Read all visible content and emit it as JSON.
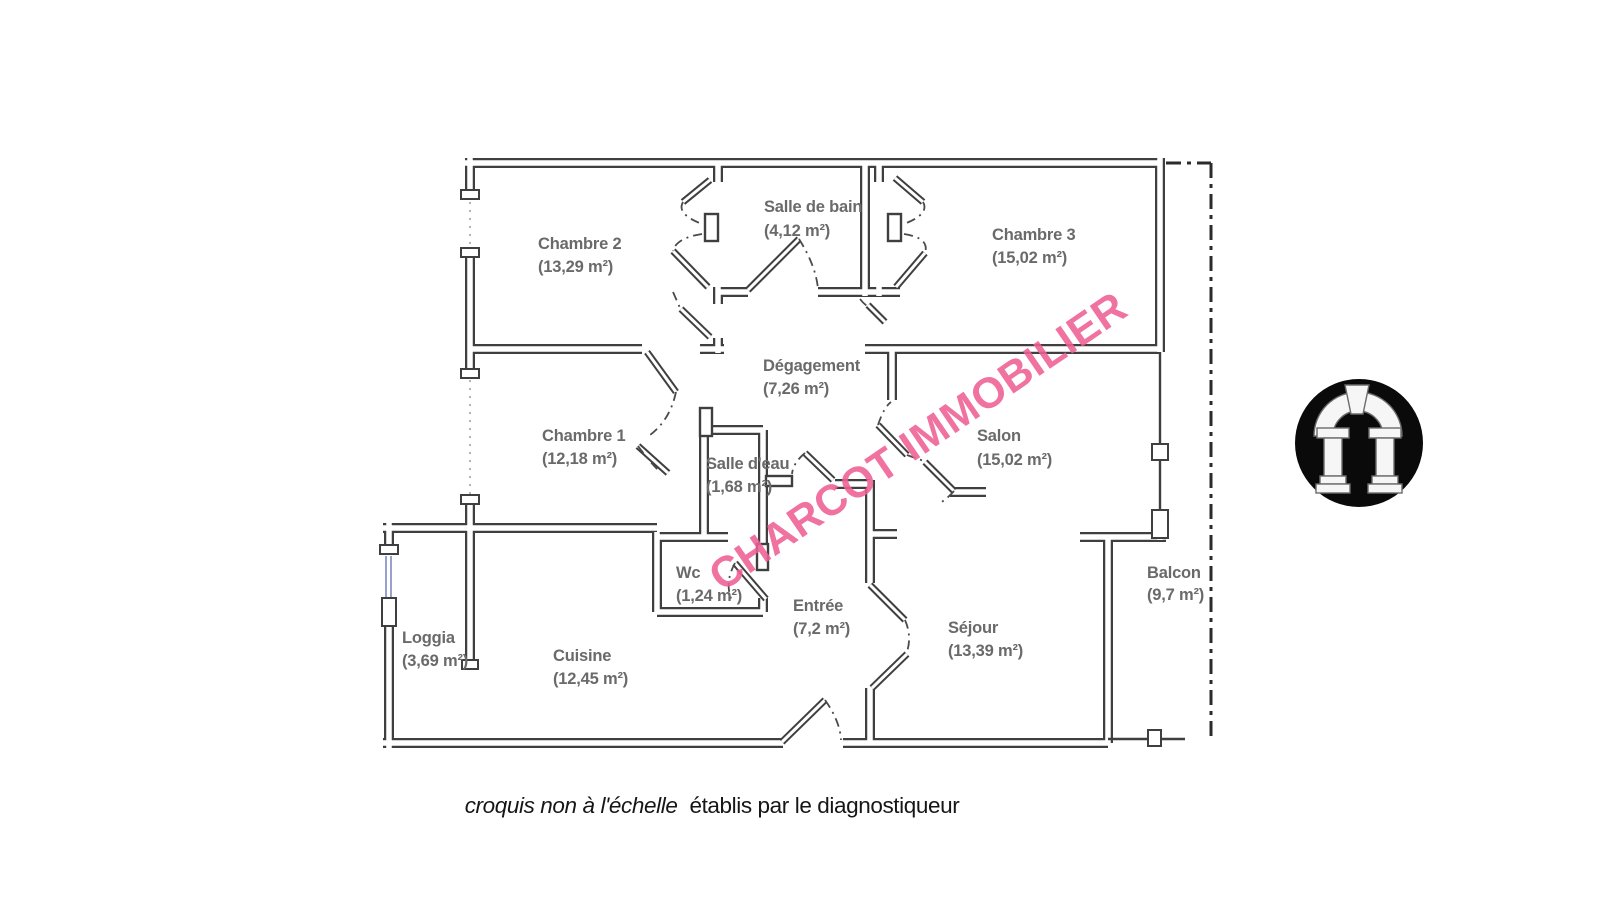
{
  "watermark": {
    "text": "CHARCOT IMMOBILIER",
    "color": "#ef5f94"
  },
  "caption": {
    "italic_part": "croquis non à l'échelle",
    "regular_part": "établis par le diagnostiqueur"
  },
  "rooms": [
    {
      "name": "Chambre 2",
      "area": "(13,29 m²)"
    },
    {
      "name": "Salle de bain",
      "area": "(4,12 m²)"
    },
    {
      "name": "Chambre 3",
      "area": "(15,02 m²)"
    },
    {
      "name": "Dégagement",
      "area": "(7,26 m²)"
    },
    {
      "name": "Chambre 1",
      "area": "(12,18 m²)"
    },
    {
      "name": "Salle d'eau",
      "area": "(1,68 m²)"
    },
    {
      "name": "Salon",
      "area": "(15,02 m²)"
    },
    {
      "name": "Wc",
      "area": "(1,24 m²)"
    },
    {
      "name": "Entrée",
      "area": "(7,2 m²)"
    },
    {
      "name": "Séjour",
      "area": "(13,39 m²)"
    },
    {
      "name": "Balcon",
      "area": "(9,7 m²)"
    },
    {
      "name": "Loggia",
      "area": "(3,69 m²)"
    },
    {
      "name": "Cuisine",
      "area": "(12,45 m²)"
    }
  ],
  "logo": {
    "icon": "arch-logo",
    "background_color": "#0a0a0a",
    "foreground_color": "#f6f6f6"
  }
}
